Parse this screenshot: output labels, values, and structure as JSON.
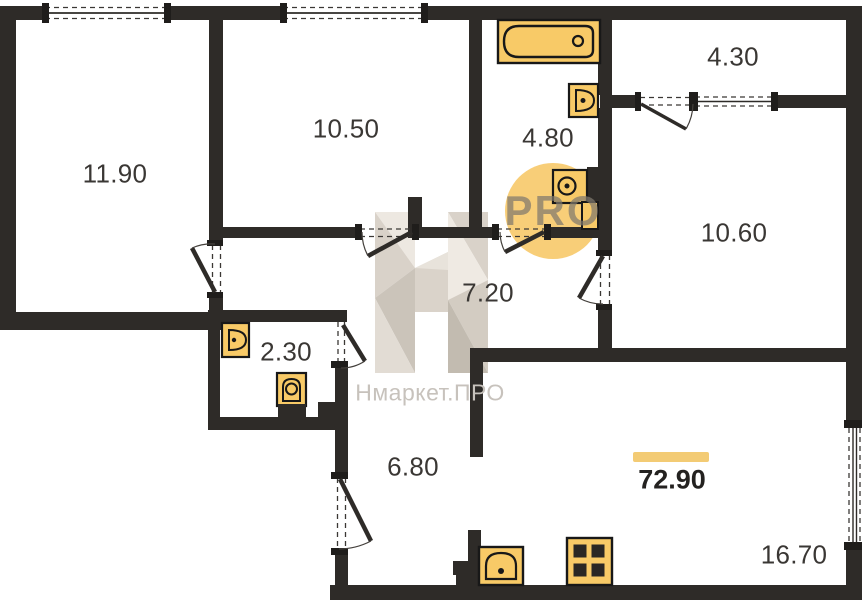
{
  "plan": {
    "rooms": [
      {
        "area": "11.90"
      },
      {
        "area": "10.50"
      },
      {
        "area": "4.80"
      },
      {
        "area": "4.30"
      },
      {
        "area": "10.60"
      },
      {
        "area": "7.20"
      },
      {
        "area": "2.30"
      },
      {
        "area": "6.80"
      },
      {
        "area": "16.70"
      }
    ],
    "total_area": "72.90"
  },
  "watermark": {
    "brand": "Нмаркет.ПРО",
    "badge": "PRO"
  },
  "icons": [
    "bathtub-icon",
    "toilet-icon",
    "sink-icon",
    "washing-machine-icon",
    "stove-icon",
    "kitchen-sink-icon",
    "door-swing-icon",
    "window-icon"
  ],
  "colors": {
    "walls": "#2E2B28",
    "fixture_fill": "#F8CA67",
    "fixture_stroke": "#181818",
    "accent_bar": "#F3CB74",
    "badge_circle": "#F7C765",
    "watermark_gray": "#C7C2BC",
    "label_text": "#3A3734"
  }
}
